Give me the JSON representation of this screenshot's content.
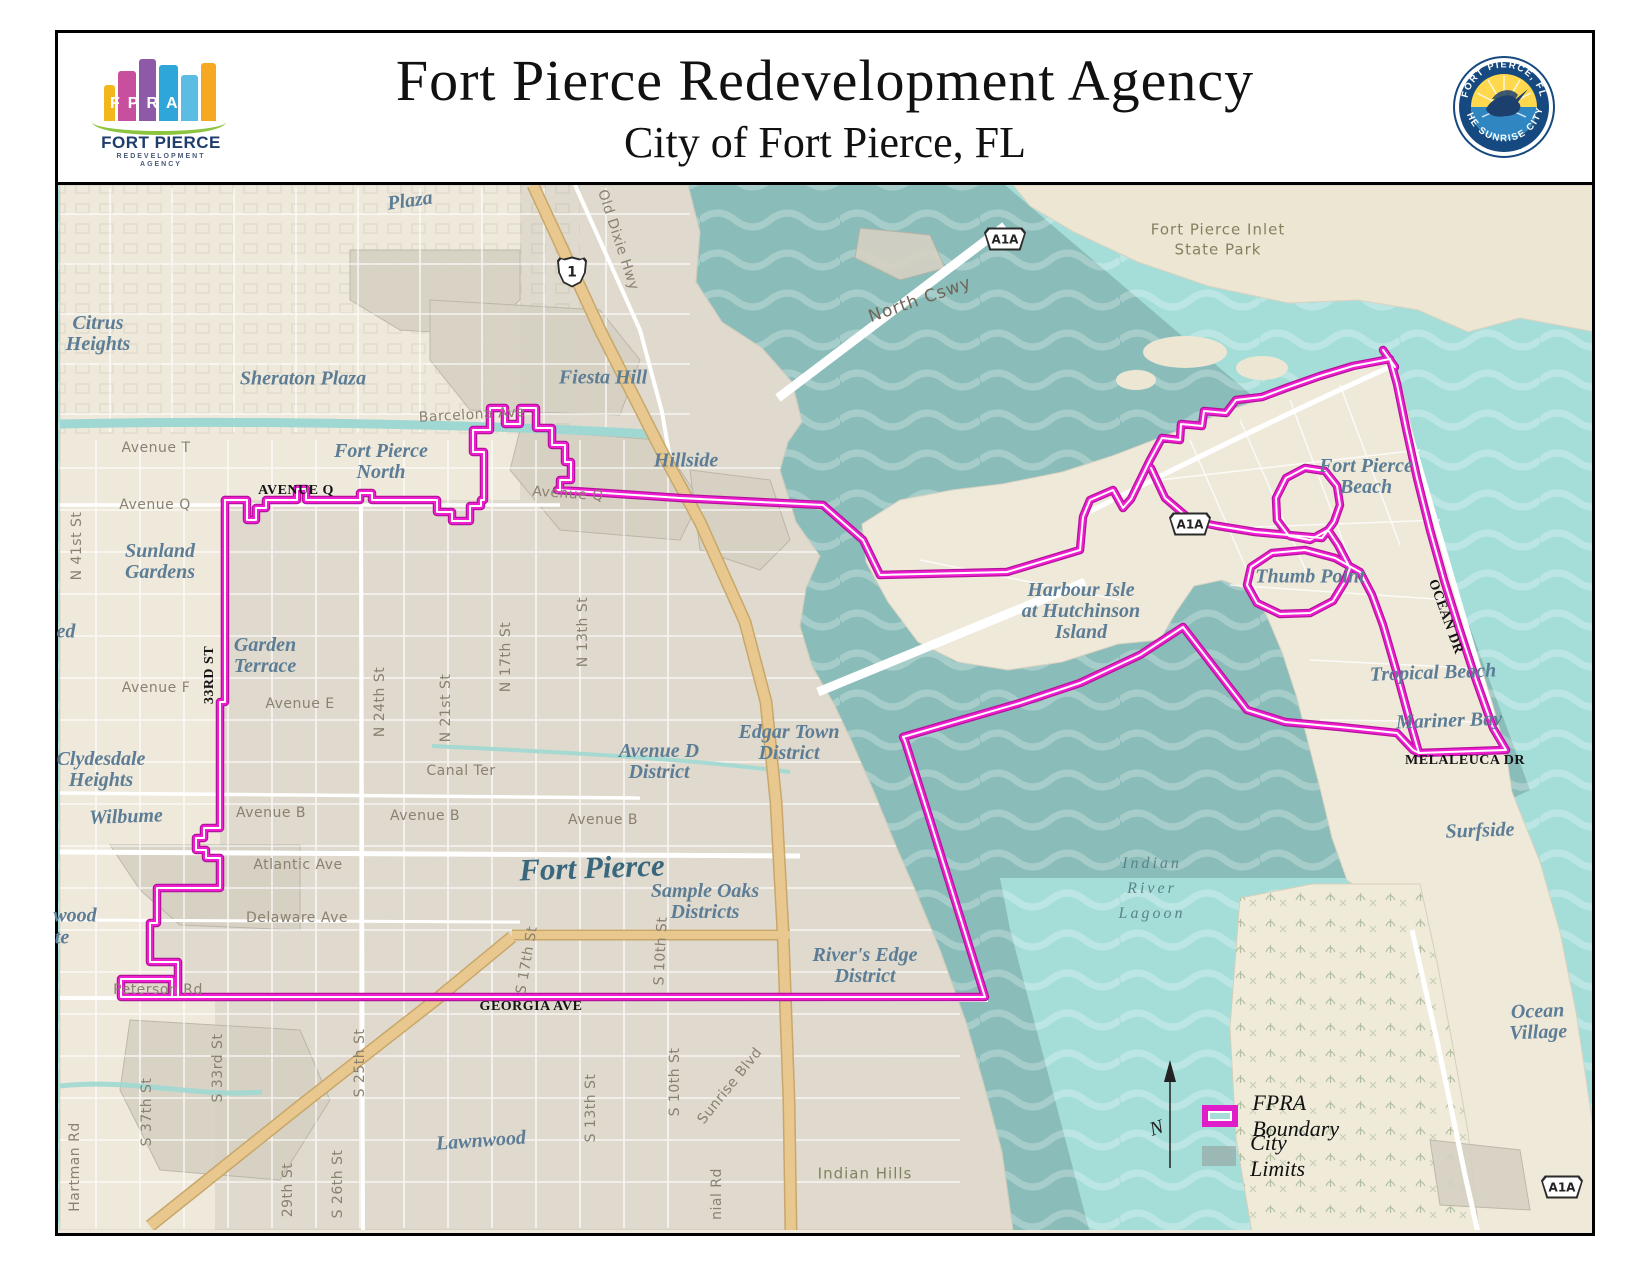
{
  "header": {
    "title": "Fort Pierce Redevelopment Agency",
    "subtitle": "City of Fort Pierce, FL",
    "logo_left": {
      "letters": [
        "F",
        "P",
        "R",
        "A"
      ],
      "name": "FORT PIERCE",
      "sub1": "REDEVELOPMENT",
      "sub2": "AGENCY"
    },
    "seal": {
      "top": "FORT PIERCE, FL",
      "bottom": "THE SUNRISE CITY"
    }
  },
  "legend": {
    "items": [
      {
        "label": "FPRA Boundary",
        "type": "boundary"
      },
      {
        "label": "City Limits",
        "type": "city"
      }
    ]
  },
  "colors": {
    "boundary": "#e81cca",
    "water": "#a5ded9",
    "water_city": "#7fb9b6",
    "land": "#efe9db",
    "road_major": "#e8c88e",
    "hood_text": "#5c7d95",
    "street_text": "#8a8171"
  },
  "map": {
    "shields": [
      {
        "type": "us",
        "text": "1",
        "x": 572,
        "y": 272
      },
      {
        "type": "a1a",
        "text": "A1A",
        "x": 1005,
        "y": 239
      },
      {
        "type": "a1a",
        "text": "A1A",
        "x": 1190,
        "y": 524
      },
      {
        "type": "a1a",
        "text": "A1A",
        "x": 1562,
        "y": 1187
      }
    ],
    "labels": [
      {
        "t": "Plaza",
        "x": 410,
        "y": 201,
        "cls": "hood",
        "rot": -8
      },
      {
        "t": "Citrus\nHeights",
        "x": 98,
        "y": 334,
        "cls": "hood"
      },
      {
        "t": "Sheraton Plaza",
        "x": 303,
        "y": 379,
        "cls": "hood"
      },
      {
        "t": "Barcelona Ave",
        "x": 472,
        "y": 415,
        "cls": "street",
        "rot": -3
      },
      {
        "t": "Fiesta Hill",
        "x": 603,
        "y": 378,
        "cls": "hood"
      },
      {
        "t": "Old Dixie Hwy",
        "x": 618,
        "y": 240,
        "cls": "street",
        "rot": 72
      },
      {
        "t": "Fort Pierce\nNorth",
        "x": 381,
        "y": 462,
        "cls": "hood"
      },
      {
        "t": "Hillside",
        "x": 686,
        "y": 461,
        "cls": "hood"
      },
      {
        "t": "North Cswy",
        "x": 920,
        "y": 300,
        "cls": "street-lg",
        "rot": -19
      },
      {
        "t": "Fort Pierce Inlet\nState Park",
        "x": 1218,
        "y": 240,
        "cls": "park"
      },
      {
        "t": "Avenue T",
        "x": 156,
        "y": 448,
        "cls": "street"
      },
      {
        "t": "Avenue Q",
        "x": 155,
        "y": 505,
        "cls": "street"
      },
      {
        "t": "AVENUE Q",
        "x": 296,
        "y": 491,
        "cls": "black"
      },
      {
        "t": "Avenue Q",
        "x": 568,
        "y": 494,
        "cls": "street",
        "rot": 4
      },
      {
        "t": "N 41st St",
        "x": 77,
        "y": 546,
        "cls": "street",
        "rot": -90
      },
      {
        "t": "Sunland\nGardens",
        "x": 160,
        "y": 562,
        "cls": "hood"
      },
      {
        "t": "ed",
        "x": 66,
        "y": 632,
        "cls": "hood"
      },
      {
        "t": "33RD ST",
        "x": 210,
        "y": 675,
        "cls": "black",
        "rot": -90
      },
      {
        "t": "Garden\nTerrace",
        "x": 265,
        "y": 656,
        "cls": "hood"
      },
      {
        "t": "Avenue F",
        "x": 156,
        "y": 688,
        "cls": "street"
      },
      {
        "t": "Avenue E",
        "x": 300,
        "y": 704,
        "cls": "street"
      },
      {
        "t": "N 24th St",
        "x": 380,
        "y": 702,
        "cls": "street",
        "rot": -90
      },
      {
        "t": "N 21st St",
        "x": 446,
        "y": 708,
        "cls": "street",
        "rot": -90
      },
      {
        "t": "N 17th St",
        "x": 506,
        "y": 657,
        "cls": "street",
        "rot": -90
      },
      {
        "t": "N 13th St",
        "x": 583,
        "y": 632,
        "cls": "street",
        "rot": -90
      },
      {
        "t": "Canal Ter",
        "x": 461,
        "y": 771,
        "cls": "street"
      },
      {
        "t": "Clydesdale\nHeights",
        "x": 101,
        "y": 770,
        "cls": "hood"
      },
      {
        "t": "Wilbume",
        "x": 126,
        "y": 817,
        "cls": "hood",
        "rot": -2
      },
      {
        "t": "Avenue B",
        "x": 271,
        "y": 813,
        "cls": "street"
      },
      {
        "t": "Avenue B",
        "x": 425,
        "y": 816,
        "cls": "street"
      },
      {
        "t": "Avenue B",
        "x": 603,
        "y": 820,
        "cls": "street"
      },
      {
        "t": "Atlantic Ave",
        "x": 298,
        "y": 865,
        "cls": "street"
      },
      {
        "t": "wood",
        "x": 75,
        "y": 916,
        "cls": "hood"
      },
      {
        "t": "te",
        "x": 62,
        "y": 938,
        "cls": "hood"
      },
      {
        "t": "Delaware Ave",
        "x": 297,
        "y": 918,
        "cls": "street"
      },
      {
        "t": "Fort Pierce",
        "x": 592,
        "y": 868,
        "cls": "hood-lg",
        "rot": -2
      },
      {
        "t": "Sample Oaks\nDistricts",
        "x": 705,
        "y": 902,
        "cls": "hood"
      },
      {
        "t": "Avenue D\nDistrict",
        "x": 659,
        "y": 762,
        "cls": "hood"
      },
      {
        "t": "Edgar Town\nDistrict",
        "x": 789,
        "y": 743,
        "cls": "hood"
      },
      {
        "t": "River's Edge\nDistrict",
        "x": 865,
        "y": 966,
        "cls": "hood"
      },
      {
        "t": "Peterson Rd",
        "x": 158,
        "y": 990,
        "cls": "street"
      },
      {
        "t": "GEORGIA AVE",
        "x": 531,
        "y": 1007,
        "cls": "black"
      },
      {
        "t": "S 17th St",
        "x": 527,
        "y": 960,
        "cls": "street",
        "rot": -80
      },
      {
        "t": "S 10th St",
        "x": 661,
        "y": 951,
        "cls": "street",
        "rot": -87
      },
      {
        "t": "Sunrise Blvd",
        "x": 730,
        "y": 1086,
        "cls": "street",
        "rot": -51
      },
      {
        "t": "S 13th St",
        "x": 591,
        "y": 1108,
        "cls": "street",
        "rot": -90
      },
      {
        "t": "S 10th St",
        "x": 675,
        "y": 1082,
        "cls": "street",
        "rot": -90
      },
      {
        "t": "nial Rd",
        "x": 717,
        "y": 1194,
        "cls": "street",
        "rot": -90
      },
      {
        "t": "Lawnwood",
        "x": 481,
        "y": 1141,
        "cls": "hood",
        "rot": -4
      },
      {
        "t": "Indian Hills",
        "x": 865,
        "y": 1174,
        "cls": "park"
      },
      {
        "t": "Hartman Rd",
        "x": 75,
        "y": 1167,
        "cls": "street",
        "rot": -90
      },
      {
        "t": "S 37th St",
        "x": 147,
        "y": 1112,
        "cls": "street",
        "rot": -90
      },
      {
        "t": "S 33rd St",
        "x": 218,
        "y": 1068,
        "cls": "street",
        "rot": -90
      },
      {
        "t": "29th St",
        "x": 288,
        "y": 1190,
        "cls": "street",
        "rot": -90
      },
      {
        "t": "S 26th St",
        "x": 338,
        "y": 1184,
        "cls": "street",
        "rot": -90
      },
      {
        "t": "S 25th St",
        "x": 360,
        "y": 1063,
        "cls": "street",
        "rot": -90
      },
      {
        "t": "Harbour Isle\nat Hutchinson\nIsland",
        "x": 1081,
        "y": 611,
        "cls": "hood"
      },
      {
        "t": "Fort Pierce\nBeach",
        "x": 1366,
        "y": 477,
        "cls": "hood"
      },
      {
        "t": "Thumb Point",
        "x": 1310,
        "y": 577,
        "cls": "hood"
      },
      {
        "t": "OCEAN DR",
        "x": 1445,
        "y": 617,
        "cls": "black",
        "rot": 70
      },
      {
        "t": "Tropical Beach",
        "x": 1433,
        "y": 673,
        "cls": "hood",
        "rot": -2
      },
      {
        "t": "Mariner Bay",
        "x": 1449,
        "y": 721,
        "cls": "hood",
        "rot": -2
      },
      {
        "t": "MELALEUCA DR",
        "x": 1465,
        "y": 761,
        "cls": "black"
      },
      {
        "t": "Surfside",
        "x": 1480,
        "y": 831,
        "cls": "hood",
        "rot": -2
      },
      {
        "t": "Indian\nRiver\nLagoon",
        "x": 1152,
        "y": 889,
        "cls": "water"
      },
      {
        "t": "Ocean Village",
        "x": 1538,
        "y": 1022,
        "cls": "hood",
        "rot": -2
      }
    ]
  }
}
